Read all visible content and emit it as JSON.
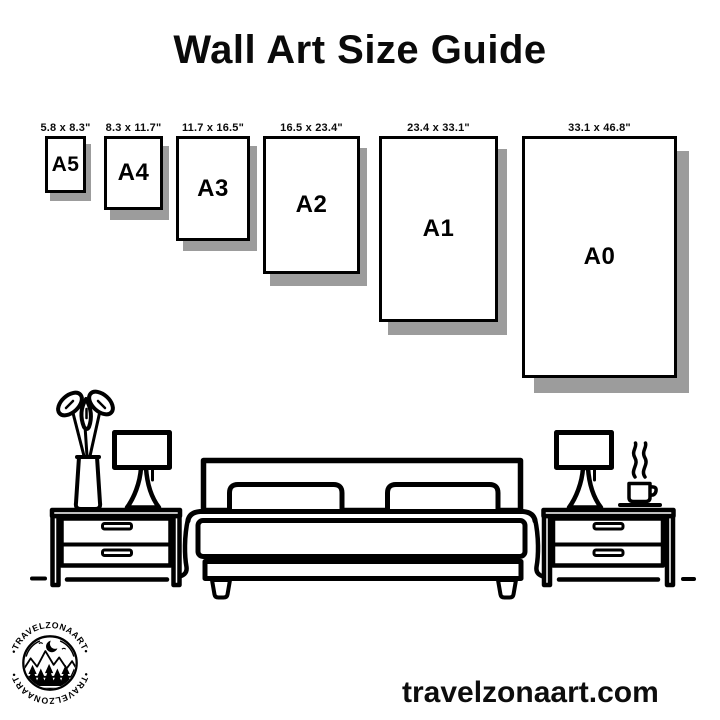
{
  "title": "Wall Art Size Guide",
  "website": "travelzonaart.com",
  "logo": {
    "brand": "TRAVELZONAART",
    "ring_text_top": "•TRAVELZONAART•",
    "ring_text_bottom": "•TRAVELZONAART•"
  },
  "size_guide": {
    "items": [
      {
        "code": "A5",
        "dimensions": "5.8 x 8.3\""
      },
      {
        "code": "A4",
        "dimensions": "8.3 x 11.7\""
      },
      {
        "code": "A3",
        "dimensions": "11.7 x 16.5\""
      },
      {
        "code": "A2",
        "dimensions": "16.5 x 23.4\""
      },
      {
        "code": "A1",
        "dimensions": "23.4 x 33.1\""
      },
      {
        "code": "A0",
        "dimensions": "33.1 x 46.8\""
      }
    ]
  },
  "colors": {
    "ink": "#000000",
    "shadow": "#9c9c9c",
    "background": "#ffffff"
  },
  "illustration": {
    "name": "bedroom-scene",
    "elements": [
      "plant-vase",
      "table-lamp-left",
      "nightstand-left",
      "bed",
      "pillows",
      "nightstand-right",
      "table-lamp-right",
      "coffee-cup",
      "floor-line"
    ]
  }
}
